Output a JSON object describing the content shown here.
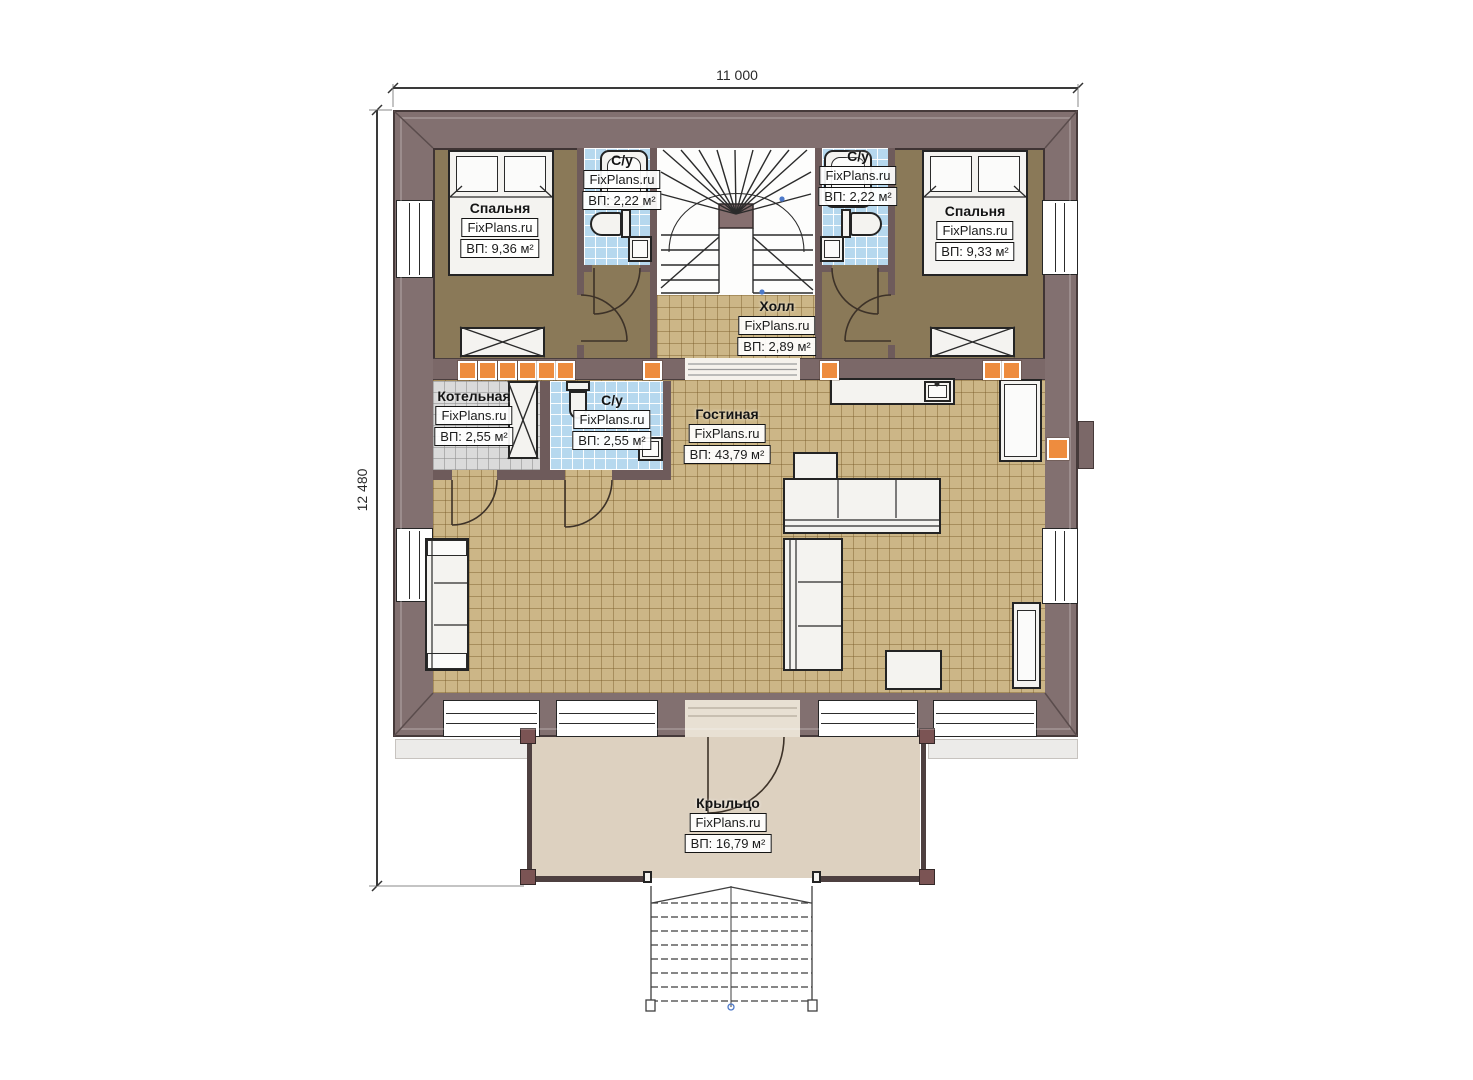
{
  "dimensions": {
    "top": "11 000",
    "left": "12 480"
  },
  "rooms": [
    {
      "id": "bedroom-left",
      "name": "Спальня",
      "brand": "FixPlans.ru",
      "area": "ВП: 9,36 м²"
    },
    {
      "id": "bathroom-top-left",
      "name": "С/у",
      "brand": "FixPlans.ru",
      "area": "ВП: 2,22 м²"
    },
    {
      "id": "bathroom-top-right",
      "name": "С/у",
      "brand": "FixPlans.ru",
      "area": "ВП: 2,22 м²"
    },
    {
      "id": "bedroom-right",
      "name": "Спальня",
      "brand": "FixPlans.ru",
      "area": "ВП: 9,33 м²"
    },
    {
      "id": "hall",
      "name": "Холл",
      "brand": "FixPlans.ru",
      "area": "ВП: 2,89 м²"
    },
    {
      "id": "boiler-room",
      "name": "Котельная",
      "brand": "FixPlans.ru",
      "area": "ВП: 2,55 м²"
    },
    {
      "id": "bathroom-lower",
      "name": "С/у",
      "brand": "FixPlans.ru",
      "area": "ВП: 2,55 м²"
    },
    {
      "id": "living-room",
      "name": "Гостиная",
      "brand": "FixPlans.ru",
      "area": "ВП: 43,79 м²"
    },
    {
      "id": "porch",
      "name": "Крыльцо",
      "brand": "FixPlans.ru",
      "area": "ВП: 16,79 м²"
    }
  ],
  "colors": {
    "wall": "#827070",
    "interior_wall": "#6e5b5b",
    "floor_bedroom": "#8a7958",
    "floor_living": "#ccb687",
    "floor_bathroom": "#b6d8ee",
    "floor_boiler": "#dadada",
    "floor_porch": "#ddd1c0",
    "marker": "#ee8c3e"
  }
}
